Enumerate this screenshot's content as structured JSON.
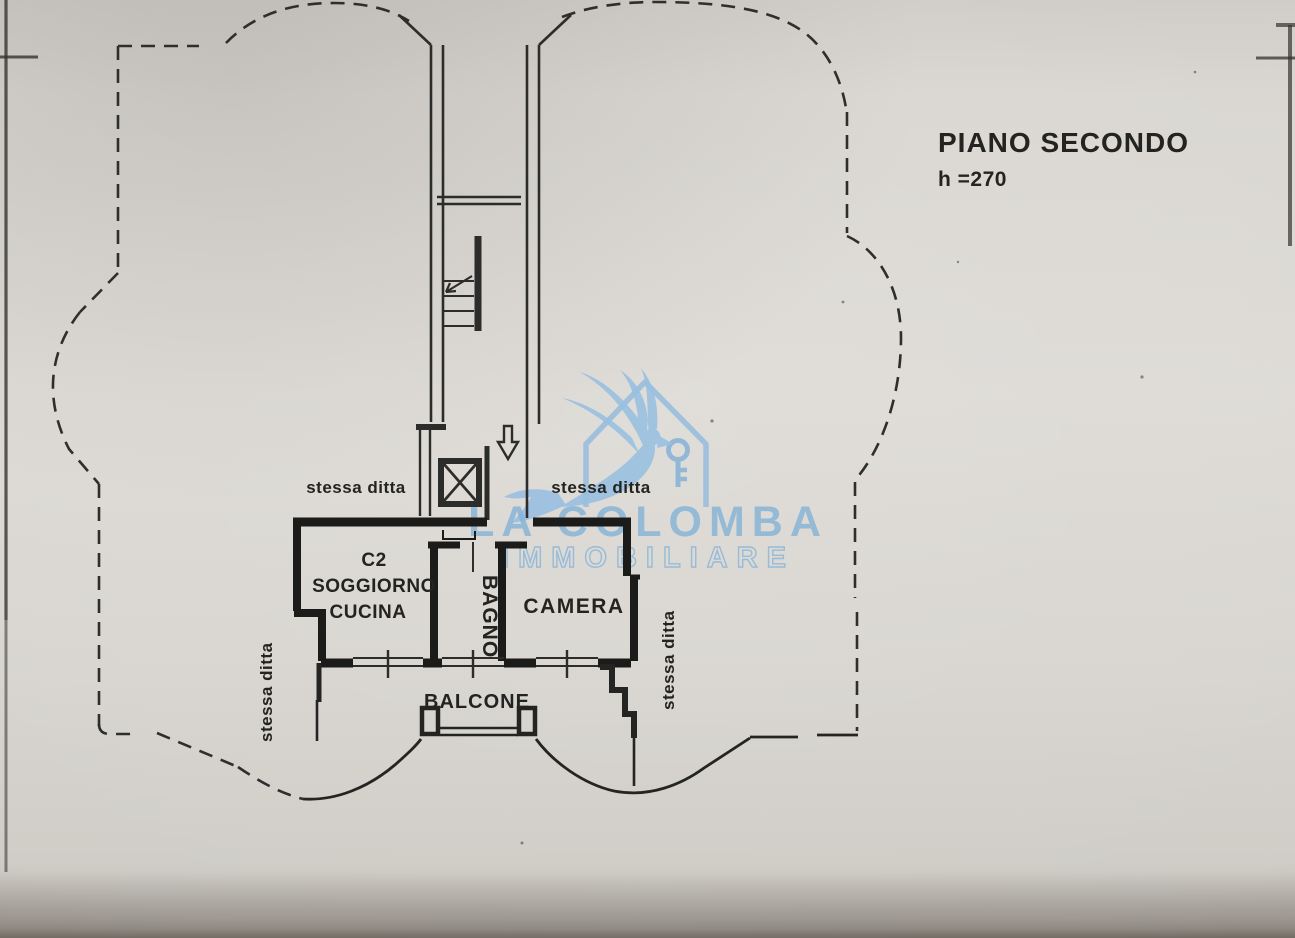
{
  "title": {
    "line1": "PIANO SECONDO",
    "line2": "h =270"
  },
  "rooms": {
    "soggiorno": [
      "C2",
      "SOGGIORNO",
      "CUCINA"
    ],
    "bagno": "BAGNO",
    "camera": "CAMERA",
    "balcone": "BALCONE"
  },
  "boundary_labels": {
    "left_horizontal": "stessa ditta",
    "right_horizontal": "stessa ditta",
    "left_vertical": "stessa ditta",
    "right_vertical": "stessa ditta"
  },
  "watermark": {
    "line1": "LA COLOMBA",
    "line2": "IMMOBILIARE"
  },
  "icons": {
    "elevator": "elevator-crossed-box",
    "stairs": "stair-flight",
    "entrance_arrow": "down-arrow",
    "stairs_arrow": "up-direction-arrow",
    "logo": "dove-with-key-and-house"
  },
  "colors": {
    "paper": "#d8d5d0",
    "ink": "#21211f",
    "wall": "#1b1b19",
    "watermark_blue": "#7db3e0"
  }
}
